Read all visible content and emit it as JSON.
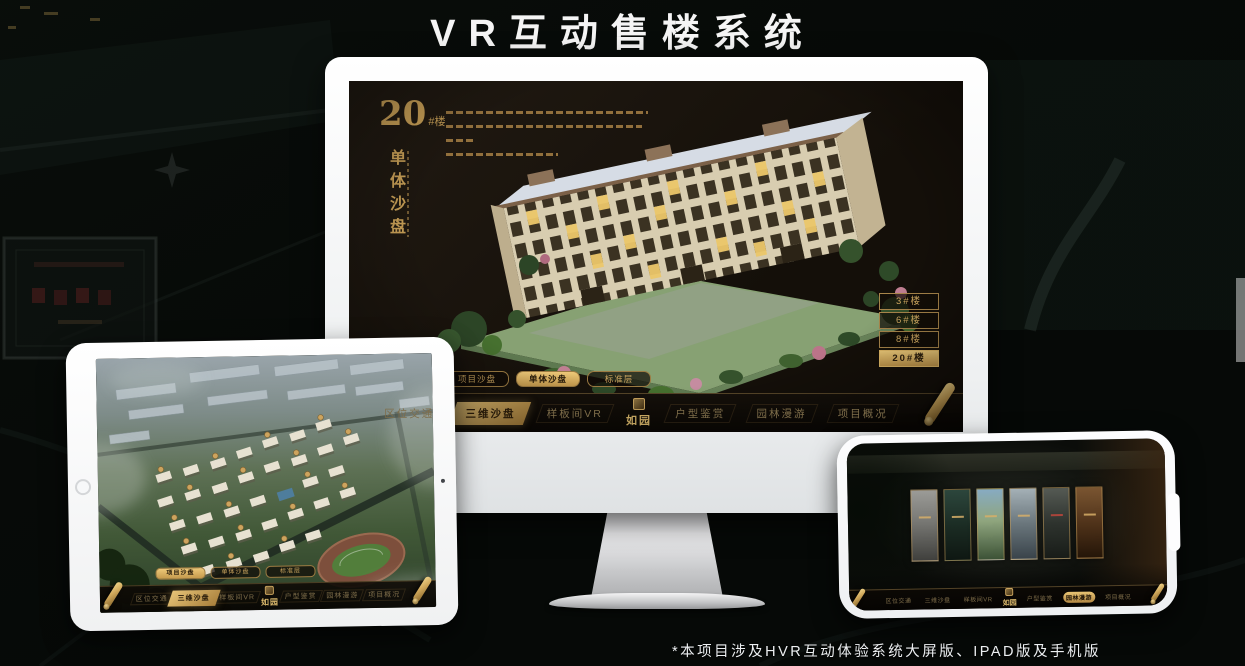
{
  "page": {
    "title": "VR互动售楼系统",
    "footnote": "*本项目涉及HVR互动体验系统大屏版、IPAD版及手机版"
  },
  "colors": {
    "gold_accent": "#c9a45e",
    "gold_bright": "#eecb79",
    "screen_background": "#17110a",
    "title_white": "#f5f5f5"
  },
  "monitor": {
    "project": {
      "number": "20",
      "suffix": "#楼",
      "subtitle": "单体沙盘"
    },
    "floor_buttons": [
      {
        "label": "3#楼",
        "active": false
      },
      {
        "label": "6#楼",
        "active": false
      },
      {
        "label": "8#楼",
        "active": false
      },
      {
        "label": "20#楼",
        "active": true
      }
    ],
    "sub_tabs": [
      {
        "label": "项目沙盘",
        "active": false
      },
      {
        "label": "单体沙盘",
        "active": true
      },
      {
        "label": "标准层",
        "active": false
      }
    ],
    "nav": {
      "logo": "如园",
      "items": [
        {
          "label": "区位交通",
          "active": false
        },
        {
          "label": "三维沙盘",
          "active": true
        },
        {
          "label": "样板间VR",
          "active": false
        },
        {
          "label": "户型鉴赏",
          "active": false
        },
        {
          "label": "园林漫游",
          "active": false
        },
        {
          "label": "项目概况",
          "active": false
        }
      ]
    }
  },
  "tablet": {
    "sub_tabs": [
      {
        "label": "项目沙盘",
        "active": true
      },
      {
        "label": "单体沙盘",
        "active": false
      },
      {
        "label": "标准层",
        "active": false
      }
    ],
    "nav": {
      "logo": "如园",
      "items": [
        {
          "label": "区位交通",
          "active": false
        },
        {
          "label": "三维沙盘",
          "active": true
        },
        {
          "label": "样板间VR",
          "active": false
        },
        {
          "label": "户型鉴赏",
          "active": false
        },
        {
          "label": "园林漫游",
          "active": false
        },
        {
          "label": "项目概况",
          "active": false
        }
      ]
    }
  },
  "phone": {
    "nav": {
      "logo": "如园",
      "items": [
        {
          "label": "区位交通",
          "active": false
        },
        {
          "label": "三维沙盘",
          "active": false
        },
        {
          "label": "样板间VR",
          "active": false
        },
        {
          "label": "户型鉴赏",
          "active": false
        },
        {
          "label": "园林漫游",
          "active": true
        },
        {
          "label": "项目概况",
          "active": false
        }
      ]
    },
    "gallery_panel_count": 6
  }
}
